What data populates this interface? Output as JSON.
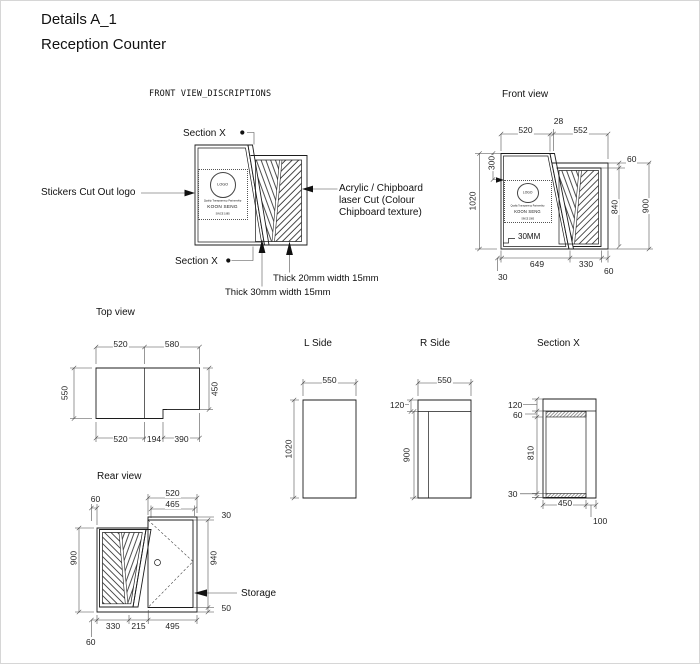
{
  "titles": {
    "line1": "Details A_1",
    "line2": "Reception Counter"
  },
  "colors": {
    "line": "#1c1c1c",
    "dim_line": "#444444",
    "background": "#ffffff"
  },
  "logo": {
    "mark": "LOGO",
    "tagline": "Quality Transparency Partnership",
    "name": "KOON SENG",
    "sub": "SINCE 1985"
  },
  "front_desc": {
    "label": "FRONT VIEW_DISCRIPTIONS",
    "section_x": "Section X",
    "stickers": "Stickers Cut Out logo",
    "acrylic1": "Acrylic  / Chipboard",
    "acrylic2": "laser Cut (Colour",
    "acrylic3": "Chipboard texture)",
    "thick20": "Thick 20mm width 15mm",
    "thick30": "Thick 30mm width 15mm"
  },
  "front_view": {
    "label": "Front view",
    "d520": "520",
    "d28": "28",
    "d552": "552",
    "d300": "300",
    "d1020": "1020",
    "d60top": "60",
    "d840": "840",
    "d900": "900",
    "note30mm": "30MM",
    "d649": "649",
    "d330": "330",
    "d60bot": "60",
    "d30": "30"
  },
  "top_view": {
    "label": "Top view",
    "d520t": "520",
    "d580": "580",
    "d550": "550",
    "d450": "450",
    "d520b": "520",
    "d194": "194",
    "d390": "390"
  },
  "l_side": {
    "label": "L Side",
    "d550": "550",
    "d1020": "1020"
  },
  "r_side": {
    "label": "R Side",
    "d550": "550",
    "d120": "120",
    "d900": "900"
  },
  "section_x": {
    "label": "Section X",
    "d120": "120",
    "d60": "60",
    "d810": "810",
    "d30": "30",
    "d450": "450",
    "d100": "100"
  },
  "rear_view": {
    "label": "Rear view",
    "d60t": "60",
    "d520": "520",
    "d465": "465",
    "d30": "30",
    "d940": "940",
    "d50": "50",
    "d900": "900",
    "d330": "330",
    "d215": "215",
    "d495": "495",
    "d60b": "60",
    "storage": "Storage"
  }
}
